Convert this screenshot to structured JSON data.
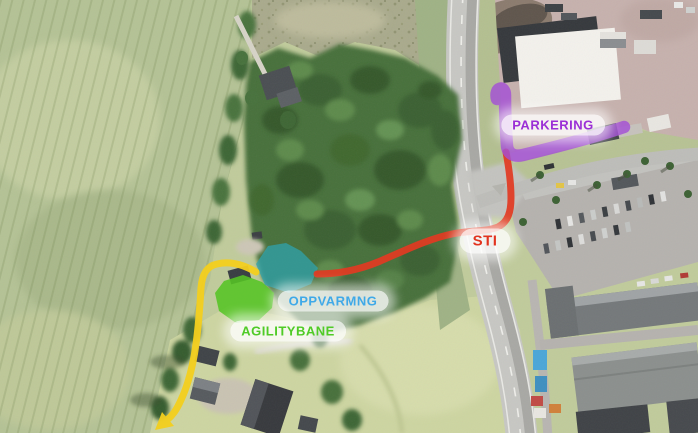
{
  "labels": {
    "parkering": "PARKERING",
    "sti": "STI",
    "oppvarmng": "OPPVARMNG",
    "agilitybane": "AGILITYBANE"
  },
  "colors": {
    "label_parkering": "#9b2fd6",
    "label_sti": "#e2331f",
    "label_oppvarmng": "#3fa9e8",
    "label_agilitybane": "#4fcb26",
    "route_parking": "#a44fd6",
    "route_trail": "#e23a22",
    "route_exit": "#f3cf1e",
    "area_warmup": "#2fa3ad",
    "area_agility": "#55c424"
  }
}
